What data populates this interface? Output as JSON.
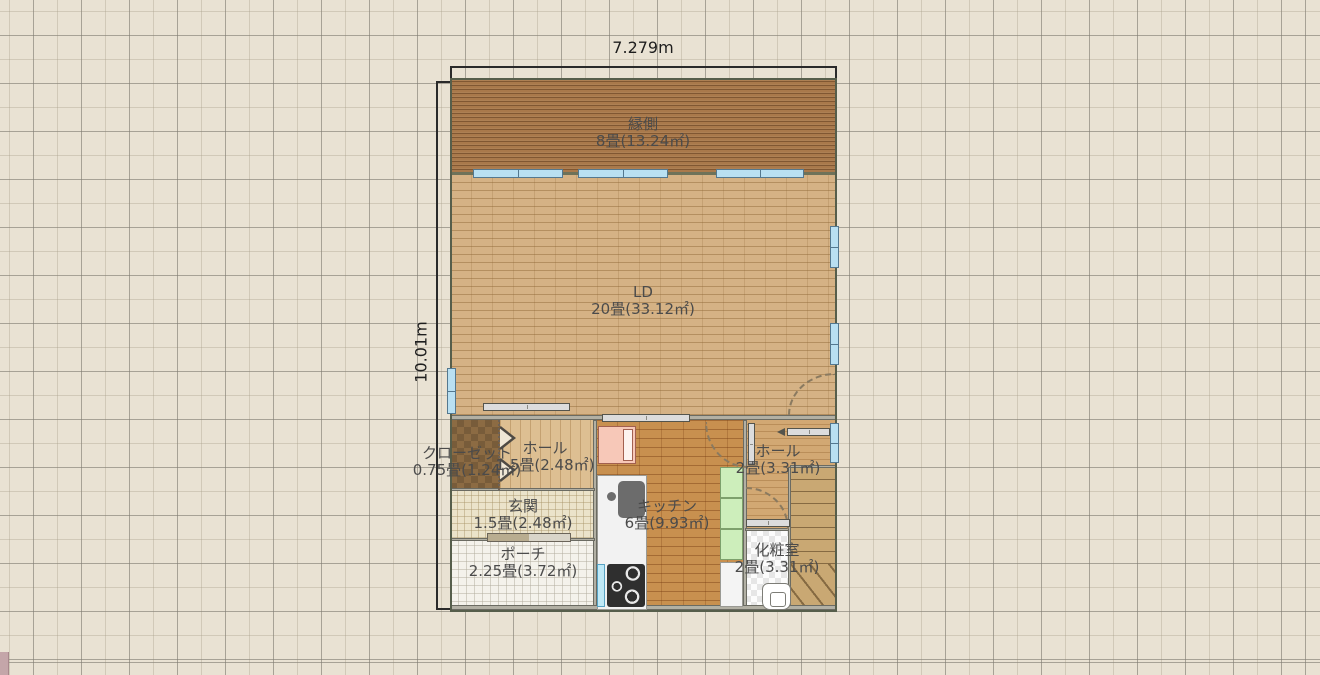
{
  "plan": {
    "dimensions": {
      "width": "7.279m",
      "height": "10.01m"
    },
    "rooms": [
      {
        "key": "engawa",
        "name": "縁側",
        "size": "8畳(13.24㎡)"
      },
      {
        "key": "ld",
        "name": "LD",
        "size": "20畳(33.12㎡)"
      },
      {
        "key": "closet",
        "name": "クローゼット",
        "size": "0.75畳(1.24㎡)"
      },
      {
        "key": "hall-front",
        "name": "ホール",
        "size": "1.5畳(2.48㎡)"
      },
      {
        "key": "genkan",
        "name": "玄関",
        "size": "1.5畳(2.48㎡)"
      },
      {
        "key": "porch",
        "name": "ポーチ",
        "size": "2.25畳(3.72㎡)"
      },
      {
        "key": "kitchen",
        "name": "キッチン",
        "size": "6畳(9.93㎡)"
      },
      {
        "key": "hall-back",
        "name": "ホール",
        "size": "2畳(3.31㎡)"
      },
      {
        "key": "powder-room",
        "name": "化粧室",
        "size": "2畳(3.31㎡)"
      }
    ],
    "colors": {
      "canvas_bg": "#e9e2d3",
      "engawa_floor": "#a9794b",
      "ld_floor": "#d5b285",
      "kitchen_floor": "#c8904f",
      "hall_floor": "#ddbf92",
      "closet_floor": "#8c6b43",
      "stairs_floor": "#c9a873",
      "window_glass": "#b9e0f2",
      "cabinet_green": "#cdeebb",
      "fridge_pink": "#f7c8b8",
      "wall_gray": "#b2b0a4"
    }
  }
}
